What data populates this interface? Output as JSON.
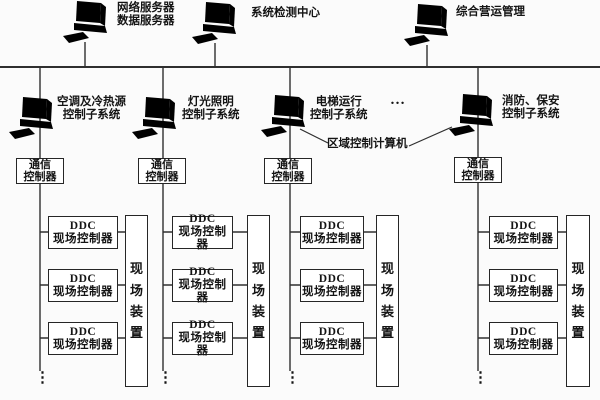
{
  "colors": {
    "background": "#fbfbfb",
    "line": "#2f2f2f",
    "text": "#141414",
    "box_fill": "#ffffff"
  },
  "top_nodes": [
    {
      "label_line1": "网络服务器",
      "label_line2": "数据服务器"
    },
    {
      "label_line1": "系统检测中心"
    },
    {
      "label_line1": "综合营运管理"
    }
  ],
  "subsystems": [
    {
      "label_line1": "空调及冷热源",
      "label_line2": "控制子系统"
    },
    {
      "label_line1": "灯光照明",
      "label_line2": "控制子系统"
    },
    {
      "label_line1": "电梯运行",
      "label_line2": "控制子系统"
    },
    {
      "label_line1": "消防、保安",
      "label_line2": "控制子系统"
    }
  ],
  "zone_controller_label": "区域控制计算机",
  "more_subsystems_ellipsis": "…",
  "comm_controller": {
    "line1": "通信",
    "line2": "控制器"
  },
  "ddc_controller": {
    "line1": "DDC",
    "line2": "现场控制器"
  },
  "field_device_label": "现场装置",
  "column_continuation_dots": "⋮"
}
